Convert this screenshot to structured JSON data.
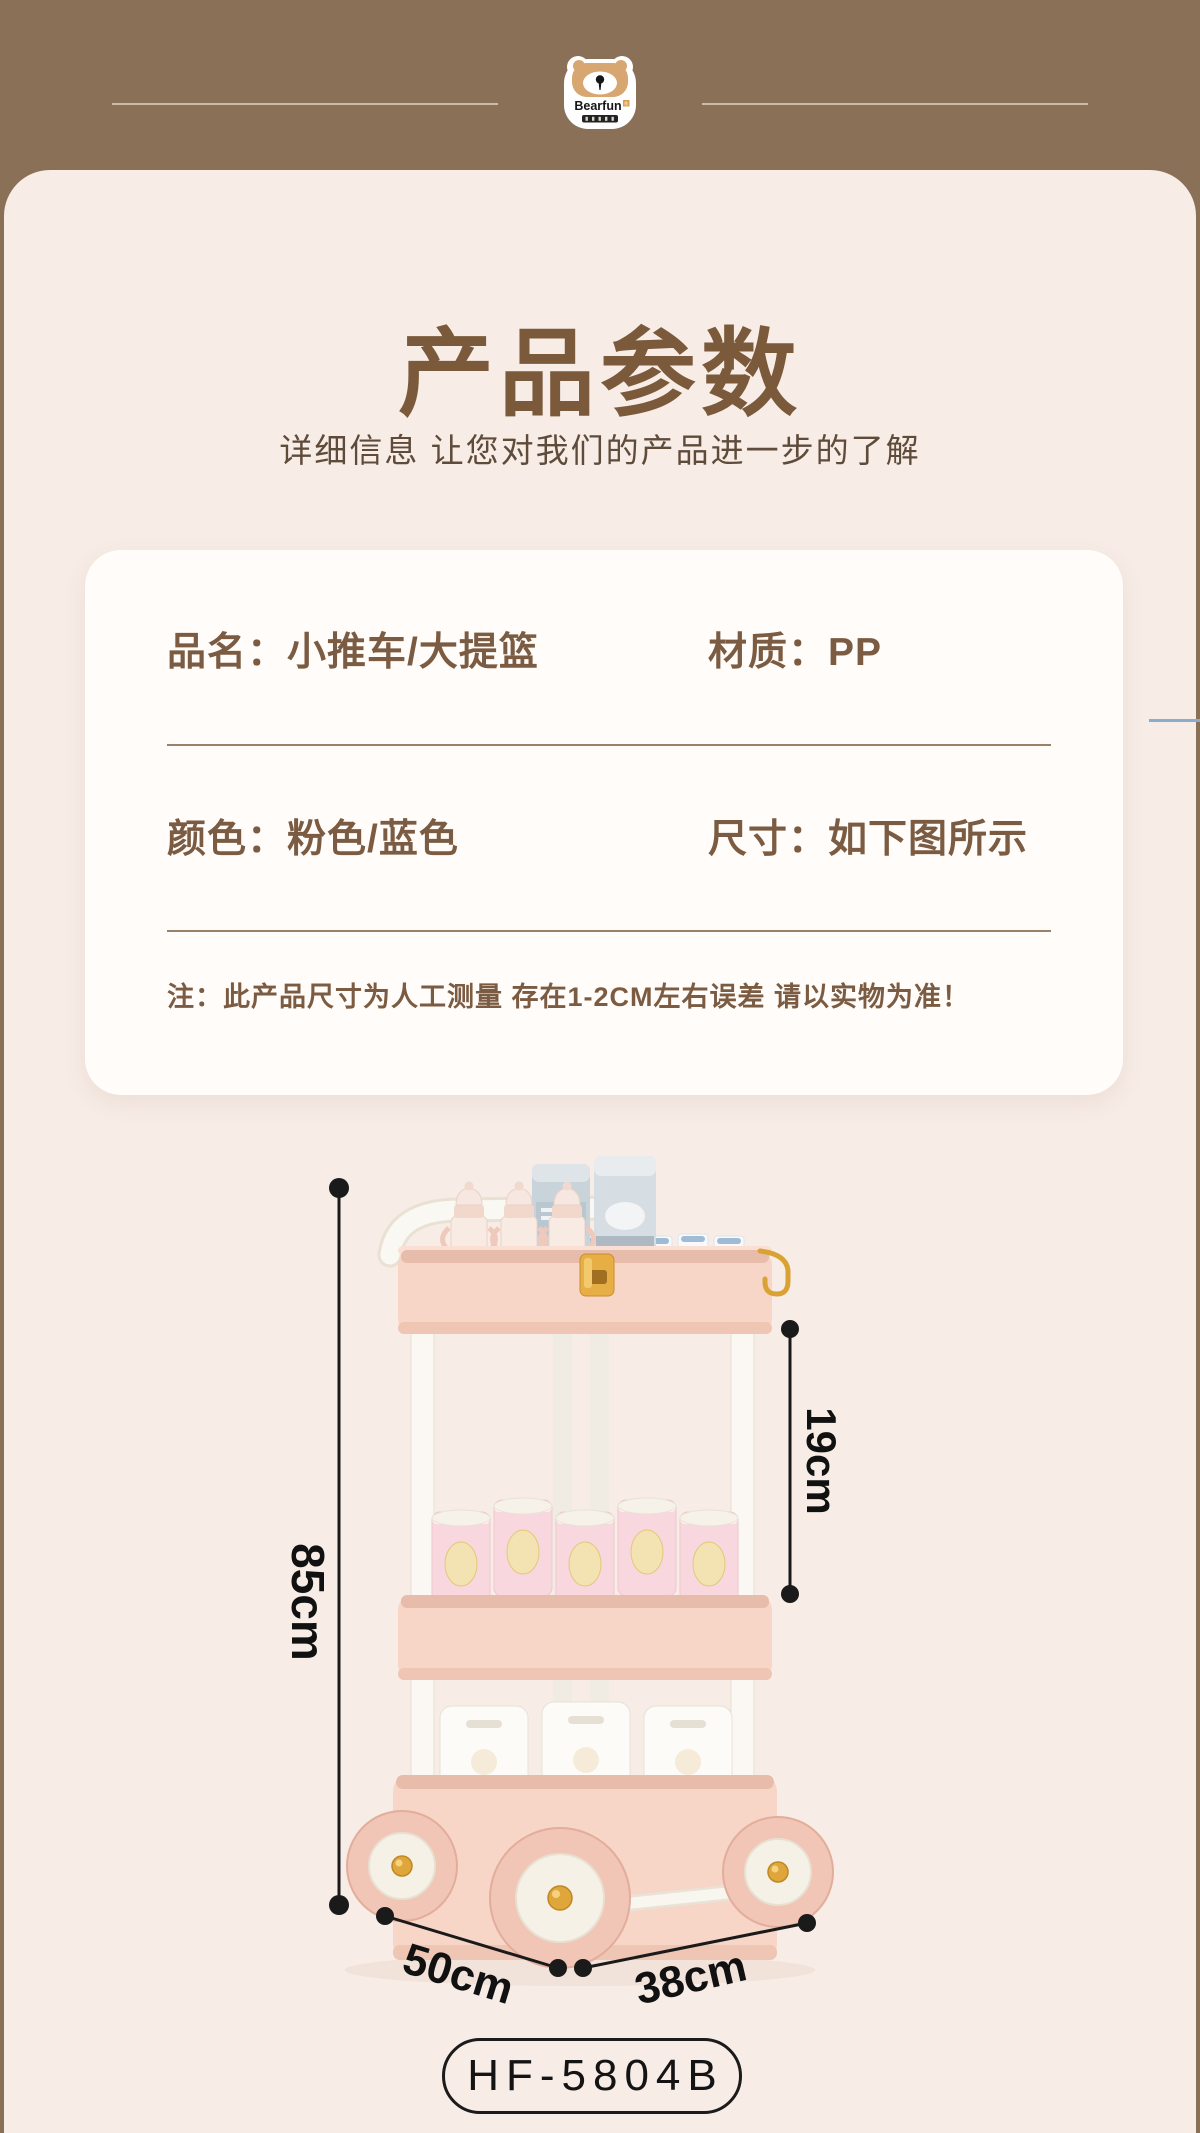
{
  "header": {
    "brand": "Bearfun",
    "brand_mark": "®",
    "logo_icon": "bear-face"
  },
  "intro": {
    "title": "产品参数",
    "subtitle": "详细信息 让您对我们的产品进一步的了解"
  },
  "spec_card": {
    "row1_left": "品名：小推车/大提篮",
    "row1_right": "材质：PP",
    "row2_left": "颜色：粉色/蓝色",
    "row2_right": "尺寸：如下图所示",
    "note": "注：此产品尺寸为人工测量 存在1-2CM左右误差 请以实物为准！"
  },
  "figure": {
    "dim_height": "85cm",
    "dim_tier_gap": "19cm",
    "dim_depth": "50cm",
    "dim_width": "38cm"
  },
  "model_badge": "HF-5804B",
  "colors": {
    "header_brown": "#8A7057",
    "panel_beige": "#F7ECE6",
    "card_white": "#FFFCF9",
    "title_brown": "#7B5A3B",
    "text_brown": "#7B5C43",
    "divider_brown": "#8A6B4F",
    "accent_blue_line": "#8CACCD",
    "trolley_pink": "#F7D6C8",
    "gold": "#E2A93F",
    "dimension_black": "#1A1A1A"
  }
}
